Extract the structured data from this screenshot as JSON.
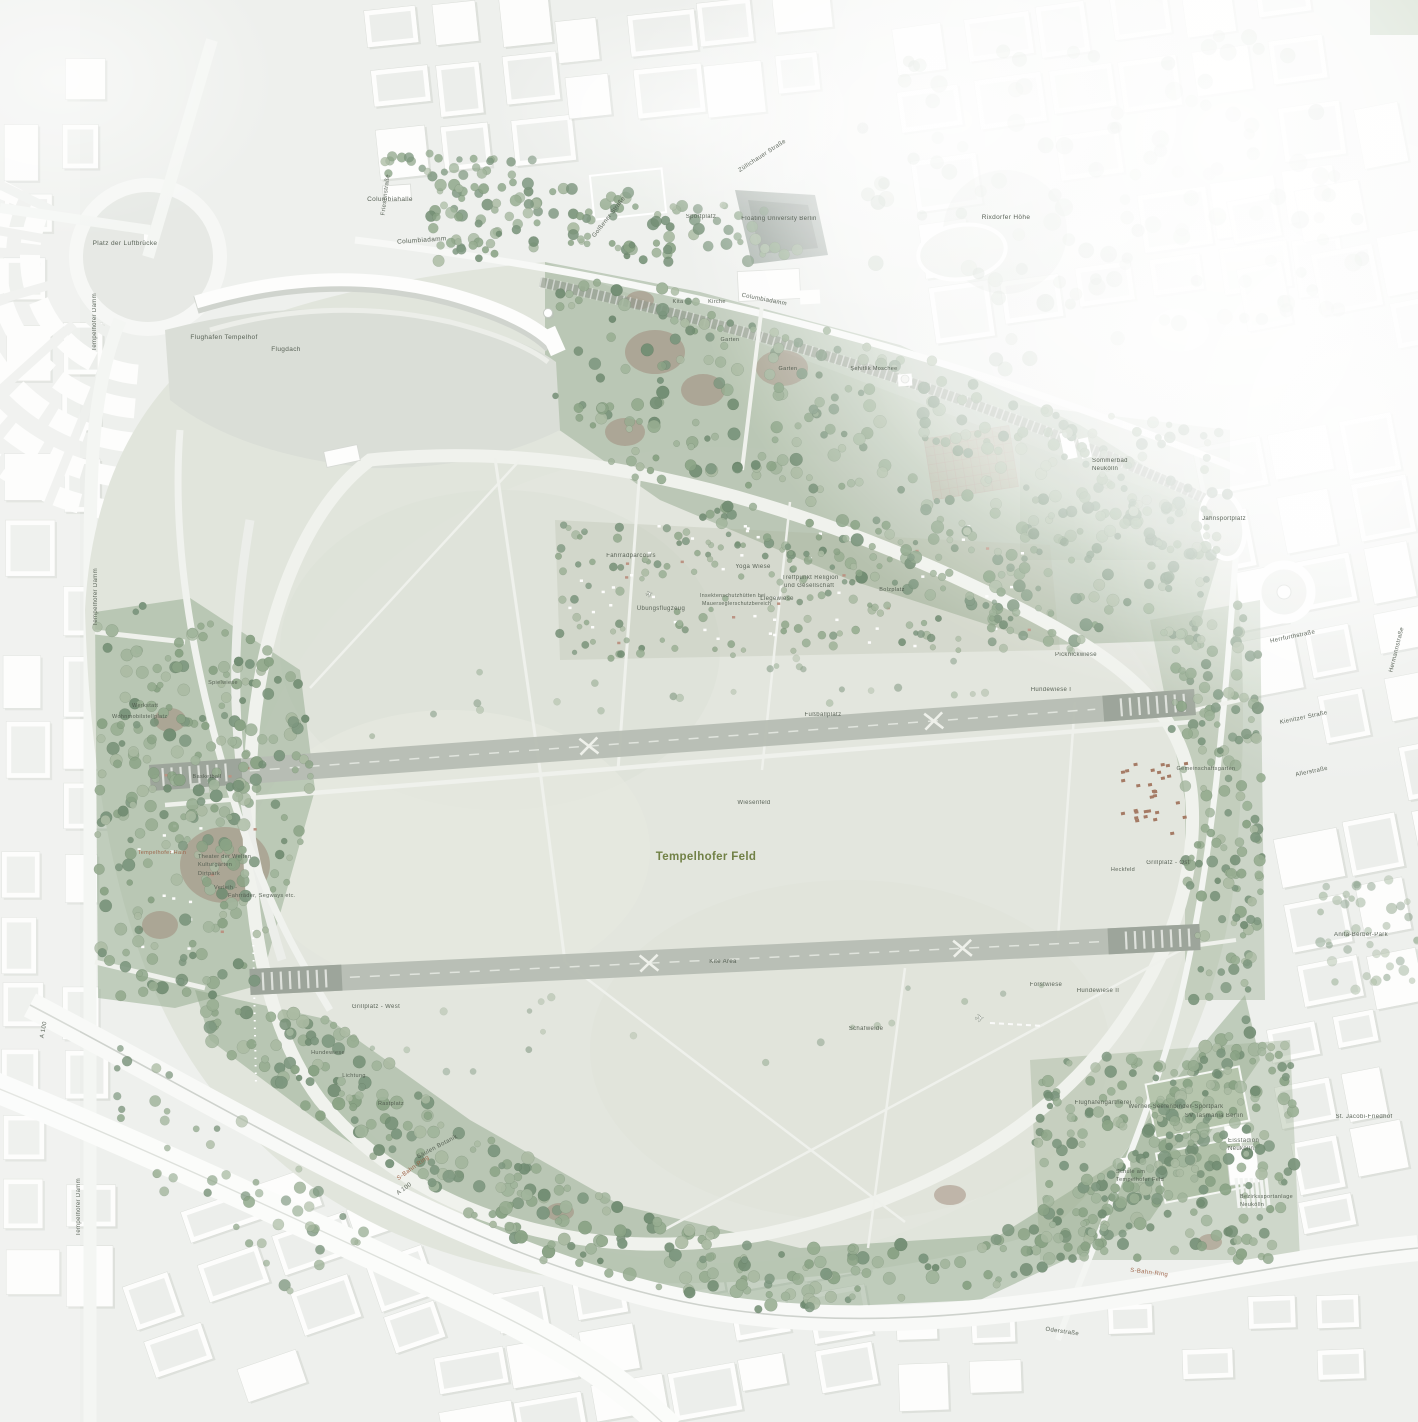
{
  "map": {
    "title": "Tempelhofer Feld",
    "colors": {
      "label": "#4e584c",
      "brown": "#9a5d41",
      "green": "#68793a",
      "field": "#e0e4db",
      "tree": "#8fa68a",
      "runway": "#b4bbb1",
      "city": "#eef0ed"
    },
    "labels": [
      {
        "t": "Platz der Luftbrücke",
        "x": 125,
        "y": 245,
        "s": 6.5
      },
      {
        "t": "Columbiahalle",
        "x": 390,
        "y": 201,
        "s": 6.5
      },
      {
        "t": "Tempelhofer Damm",
        "x": 96,
        "y": 322,
        "s": 6,
        "r": -90
      },
      {
        "t": "Tempelhofer Damm",
        "x": 97,
        "y": 597,
        "s": 6,
        "r": -90
      },
      {
        "t": "Tempelhofer Damm",
        "x": 80,
        "y": 1207,
        "s": 6,
        "r": -90
      },
      {
        "t": "Flughafen Tempelhof",
        "x": 224,
        "y": 339,
        "s": 6.5
      },
      {
        "t": "Flugdach",
        "x": 286,
        "y": 351,
        "s": 6.5
      },
      {
        "t": "Friesenstraße",
        "x": 387,
        "y": 195,
        "s": 6,
        "r": -83
      },
      {
        "t": "Columbiadamm",
        "x": 422,
        "y": 242,
        "s": 6.5,
        "r": -4
      },
      {
        "t": "Züllichauer Straße",
        "x": 763,
        "y": 157,
        "s": 6,
        "r": -33
      },
      {
        "t": "Golßener Straße",
        "x": 610,
        "y": 218,
        "s": 6,
        "r": -52
      },
      {
        "t": "Sportplatz",
        "x": 701,
        "y": 218,
        "s": 6
      },
      {
        "t": "Floating University Berlin",
        "x": 779,
        "y": 220,
        "s": 6
      },
      {
        "t": "Rixdorfer Höhe",
        "x": 1006,
        "y": 219,
        "s": 6.5
      },
      {
        "t": "Columbiadamm",
        "x": 764,
        "y": 301,
        "s": 6,
        "r": 11
      },
      {
        "t": "Kita",
        "x": 678,
        "y": 303,
        "s": 5.5
      },
      {
        "t": "Kirche",
        "x": 717,
        "y": 303,
        "s": 5.5
      },
      {
        "t": "Garten",
        "x": 730,
        "y": 341,
        "s": 5.5
      },
      {
        "t": "Garten",
        "x": 788,
        "y": 370,
        "s": 5.5
      },
      {
        "t": "Şehitlik Moschee",
        "x": 874,
        "y": 370,
        "s": 5.5
      },
      {
        "t": "Sommerbad",
        "x": 1092,
        "y": 462,
        "s": 6,
        "a": "start"
      },
      {
        "t": "Neukölln",
        "x": 1092,
        "y": 470,
        "s": 6,
        "a": "start"
      },
      {
        "t": "Jahnsportplatz",
        "x": 1224,
        "y": 520,
        "s": 6
      },
      {
        "t": "Herrfurthstraße",
        "x": 1293,
        "y": 638,
        "s": 6,
        "r": -12
      },
      {
        "t": "Kienitzer Straße",
        "x": 1304,
        "y": 719,
        "s": 6,
        "r": -12
      },
      {
        "t": "Allerstraße",
        "x": 1312,
        "y": 773,
        "s": 6,
        "r": -12
      },
      {
        "t": "Hermannstraße",
        "x": 1398,
        "y": 650,
        "s": 6,
        "r": -76
      },
      {
        "t": "Anita-Berber-Park",
        "x": 1361,
        "y": 936,
        "s": 6
      },
      {
        "t": "St. Jacobi-Friedhof",
        "x": 1364,
        "y": 1118,
        "s": 6
      },
      {
        "t": "Oderstraße",
        "x": 1062,
        "y": 1333,
        "s": 6,
        "r": 8
      },
      {
        "t": "S-Bahn-Ring",
        "x": 1149,
        "y": 1274,
        "s": 6,
        "r": 7,
        "c": "brown"
      },
      {
        "t": "S-Bahn-Ring",
        "x": 414,
        "y": 1169,
        "s": 6,
        "r": -36,
        "c": "brown"
      },
      {
        "t": "A 100",
        "x": 405,
        "y": 1190,
        "s": 6,
        "r": -36
      },
      {
        "t": "A 100",
        "x": 45,
        "y": 1030,
        "s": 6,
        "r": -80
      },
      {
        "t": "Säulen Botanik",
        "x": 438,
        "y": 1148,
        "s": 6,
        "r": -28
      },
      {
        "t": "Rastplatz",
        "x": 391,
        "y": 1105,
        "s": 5.5
      },
      {
        "t": "Lichtung",
        "x": 354,
        "y": 1077,
        "s": 5.5
      },
      {
        "t": "Hundewiese",
        "x": 328,
        "y": 1054,
        "s": 5.5
      },
      {
        "t": "Grillplatz - West",
        "x": 376,
        "y": 1008,
        "s": 6
      },
      {
        "t": "Kite Area",
        "x": 723,
        "y": 963,
        "s": 6
      },
      {
        "t": "Schafweide",
        "x": 866,
        "y": 1030,
        "s": 6
      },
      {
        "t": "Forstwiese",
        "x": 1046,
        "y": 986,
        "s": 6
      },
      {
        "t": "Hundewiese II",
        "x": 1098,
        "y": 992,
        "s": 6
      },
      {
        "t": "Hundewiese I",
        "x": 1051,
        "y": 691,
        "s": 6
      },
      {
        "t": "Picknickwiese",
        "x": 1076,
        "y": 656,
        "s": 6
      },
      {
        "t": "Fußballplatz",
        "x": 823,
        "y": 716,
        "s": 6
      },
      {
        "t": "Wiesenfeld",
        "x": 754,
        "y": 804,
        "s": 6
      },
      {
        "t": "Tempelhofer Feld",
        "x": 706,
        "y": 860,
        "s": 11.5,
        "c": "green",
        "w": "bold"
      },
      {
        "t": "Grillplatz - Ost",
        "x": 1168,
        "y": 864,
        "s": 6
      },
      {
        "t": "Heckfeld",
        "x": 1123,
        "y": 871,
        "s": 5.5
      },
      {
        "t": "Gemeinschaftsgarten",
        "x": 1206,
        "y": 770,
        "s": 5.5
      },
      {
        "t": "Fahrradparcours",
        "x": 631,
        "y": 557,
        "s": 6
      },
      {
        "t": "Yoga Wiese",
        "x": 753,
        "y": 568,
        "s": 6
      },
      {
        "t": "Treffpunkt Religion",
        "x": 782,
        "y": 579,
        "s": 6,
        "a": "start"
      },
      {
        "t": "und Gesellschaft",
        "x": 784,
        "y": 587,
        "s": 6,
        "a": "start"
      },
      {
        "t": "Liegewiese",
        "x": 777,
        "y": 600,
        "s": 6
      },
      {
        "t": "Übungsflugzeug",
        "x": 661,
        "y": 610,
        "s": 6
      },
      {
        "t": "Insektenschutzhütten bei",
        "x": 700,
        "y": 597,
        "s": 5.2,
        "a": "start"
      },
      {
        "t": "Mauerseglerschutzbereich",
        "x": 702,
        "y": 605,
        "s": 5.2,
        "a": "start"
      },
      {
        "t": "Bolzplatz",
        "x": 892,
        "y": 591,
        "s": 5.5
      },
      {
        "t": "Spielwiese",
        "x": 223,
        "y": 684,
        "s": 5.5
      },
      {
        "t": "Werkstatt",
        "x": 132,
        "y": 707,
        "s": 5.5,
        "a": "start"
      },
      {
        "t": "Wohnmobilstellplatz",
        "x": 112,
        "y": 718,
        "s": 5.5,
        "a": "start"
      },
      {
        "t": "Basketball",
        "x": 207,
        "y": 778,
        "s": 5.5
      },
      {
        "t": "Tempelhofer Hain",
        "x": 162,
        "y": 854,
        "s": 5.5,
        "c": "brown"
      },
      {
        "t": "Theater der Welten",
        "x": 198,
        "y": 858,
        "s": 5.5,
        "a": "start"
      },
      {
        "t": "Kulturgärten",
        "x": 198,
        "y": 866,
        "s": 5.5,
        "a": "start"
      },
      {
        "t": "Dirtpark",
        "x": 198,
        "y": 875,
        "s": 5.5,
        "a": "start"
      },
      {
        "t": "Verleih -",
        "x": 214,
        "y": 889,
        "s": 5.5,
        "a": "start"
      },
      {
        "t": "Fahrräder, Segways etc.",
        "x": 228,
        "y": 897,
        "s": 5.5,
        "a": "start"
      },
      {
        "t": "Flughafengärtnerei",
        "x": 1103,
        "y": 1104,
        "s": 6
      },
      {
        "t": "Werner-Seelenbinder-Sportpark",
        "x": 1176,
        "y": 1108,
        "s": 6
      },
      {
        "t": "SV Tasmania Berlin",
        "x": 1214,
        "y": 1117,
        "s": 6
      },
      {
        "t": "Eisstadion",
        "x": 1228,
        "y": 1142,
        "s": 6,
        "a": "start"
      },
      {
        "t": "Neukölln",
        "x": 1228,
        "y": 1150,
        "s": 6,
        "a": "start"
      },
      {
        "t": "Schule am",
        "x": 1116,
        "y": 1173,
        "s": 5.5,
        "a": "start"
      },
      {
        "t": "Tempelhofer Feld",
        "x": 1116,
        "y": 1181,
        "s": 5.5,
        "a": "start"
      },
      {
        "t": "Bezirkssportanlage",
        "x": 1240,
        "y": 1198,
        "s": 5.5,
        "a": "start"
      },
      {
        "t": "Neukölln",
        "x": 1240,
        "y": 1206,
        "s": 5.5,
        "a": "start"
      }
    ],
    "markers": {
      "location_dot": {
        "x": 548,
        "y": 313
      },
      "airplanes": [
        {
          "x": 650,
          "y": 597,
          "rot": -15,
          "size": 9
        },
        {
          "x": 980,
          "y": 1022,
          "rot": -6,
          "size": 11
        }
      ]
    }
  }
}
